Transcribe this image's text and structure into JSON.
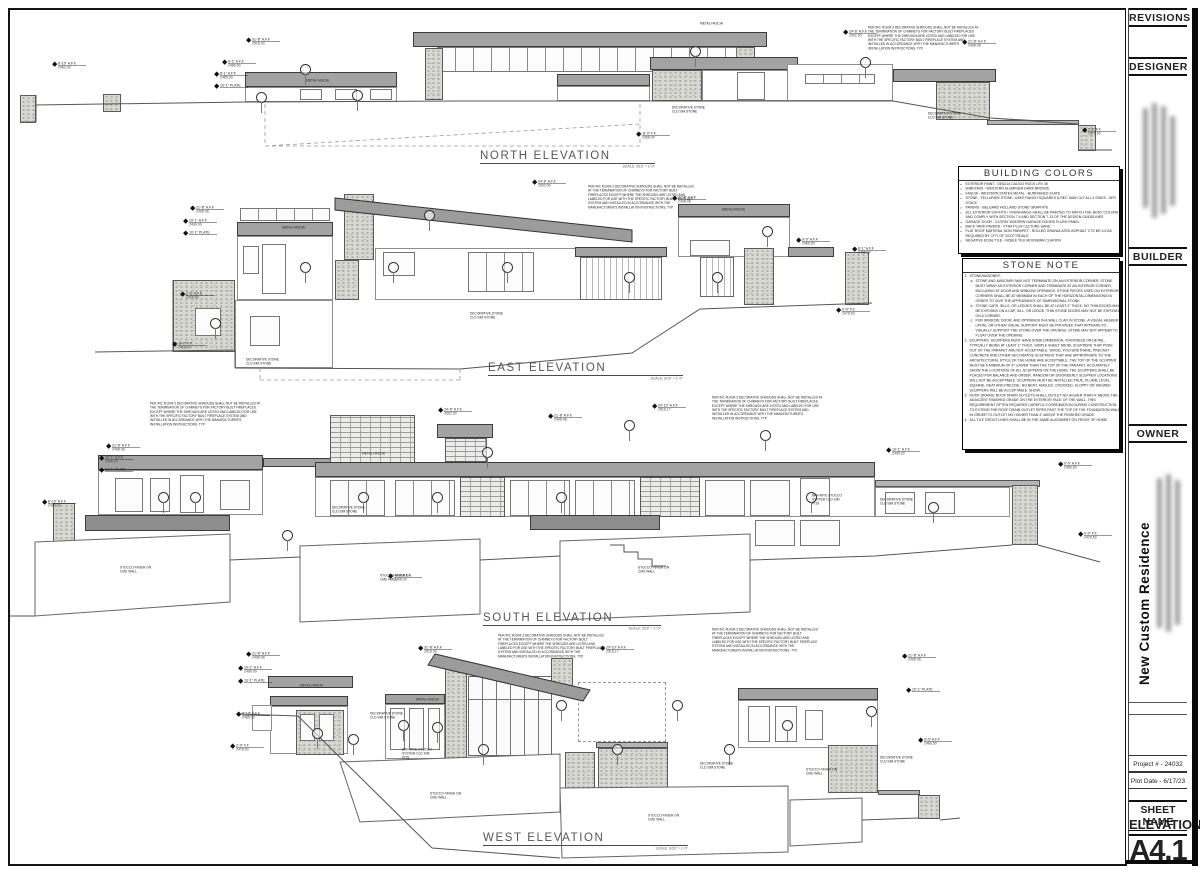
{
  "tb": {
    "revisions": "REVISIONS",
    "designer": "DESIGNER",
    "builder": "BUILDER",
    "owner": "OWNER",
    "project_name": "New Custom Residence",
    "project_number": "Project # - 24032",
    "plot_date": "Plot Date -  6/17/23",
    "sheet_name_label": "SHEET NAME",
    "sheet_name": "ELEVATIONS",
    "sheet_number": "A4.1"
  },
  "elevations": [
    {
      "id": "north",
      "title": "NORTH ELEVATION",
      "scale": "SCALE: 3/16\" = 1'-0\""
    },
    {
      "id": "east",
      "title": "EAST ELEVATION",
      "scale": "SCALE: 3/16\" = 1'-0\""
    },
    {
      "id": "south",
      "title": "SOUTH ELEVATION",
      "scale": "SCALE: 3/16\" = 1'-0\""
    },
    {
      "id": "west",
      "title": "WEST ELEVATION",
      "scale": "SCALE: 3/16\" = 1'-0\""
    }
  ],
  "notes": {
    "building_colors": {
      "title": "BUILDING COLORS",
      "items": [
        "EXTERIOR PAINT - DE6214 CALICO ROCK LRV 35",
        "WINDOWS - WESTERN ALUMINUM DARK BRONZE",
        "FASCIA - WESTERN STATES METAL - BURNISHED SLATE",
        "STONE - TELLURIDE STONE, OAKS RANCH SQUARES & REC SAW CUT ALL 4 SIDES - DRY STACK",
        "PAVERS - BELGARD HOLLAND STONE GRAPHITE",
        "ALL EXTERIOR SOFFITS / OVERHANGS SHALL BE PAINTED TO MATCH THE BODY COLORS AND COMPLY WITH SECTION 7.4 AND SECTION 7.13 OF THE DESIGN GUIDELINES",
        "GARAGE DOOR - CLOPAY MODERN GARAGE DOORS FLUSH PANEL",
        "BACK YARD PAVERS - XTRA PLUS CULTURE SAND",
        "FLAT ROOF MATERIAL NON PARAPET - ROLLED GRANULATED ASPHALT CTS BR 4.5 AS REQUIRED BY CITY OF SCOTTSDALE",
        "NEGATIVE EDGE TILE - NOBLE TILE MOSSMAN CLARION"
      ]
    },
    "stone_note": {
      "title": "STONE NOTE",
      "items": [
        {
          "b": "1.",
          "ind": 0,
          "t": "STONE/MASONRY:"
        },
        {
          "b": "a.",
          "ind": 1,
          "t": "STONE AND MASONRY MAY NOT TERMINATE ON AN EXTERIOR CORNER. STONE MUST WRAP AN EXTERIOR CORNER AND TERMINATE AT AN INTERIOR CORNER, INCLUDING AT DOOR AND WINDOW OPENINGS. STONE PIECES USED ON EXTERIOR CORNERS SHALL BE AT MINIMUM IN EACH OF THE HORIZONTAL DIMENSIONS IN ORDER TO GIVE THE APPEARANCE OF DIMENSIONAL STONE."
        },
        {
          "b": "b.",
          "ind": 1,
          "t": "STONE CAPS, SILLS, OR LEDGES SHALL BE AT LEAST 2\" THICK. NO THIN EDGES MAY BE EXPOSED ON A CAP, SILL, OR LEDGE. THIN STONE EDGES MAY NOT BE EXPOSED ON A CORNER."
        },
        {
          "b": "c.",
          "ind": 1,
          "t": "FOR WINDOW, DOOR, AND OPENINGS IN A WALL CLAD IN STONE, A VISUAL HEADER / LINTEL OR OTHER VISUAL SUPPORT MUST BE PROVIDED THAT APPEARS TO VISUALLY SUPPORT THE STONE OVER THE OPENING. STONE MAY NOT APPEAR TO FLOAT OVER THE OPENING."
        },
        {
          "b": "2.",
          "ind": 0,
          "t": "SCUPPERS: SCUPPERS MUST HAVE SOME DIMENSION, THICKNESS OR DETAIL, TYPICALLY BEING AT LEAST 1\" THICK. SIMPLE SHEET METAL SCUPPERS THAT POKE OUT OF THE PARAPET ARE NOT ACCEPTABLE. WOOD, POLYURETHANE, PRECAST CONCRETE AND OTHER DECORATIVE SCUPPERS THAT ARE APPROPRIATE TO THE ARCHITECTURAL STYLE OF THE HOME ARE ACCEPTABLE. THE TOP OF THE SCUPPER MUST BE A MINIMUM OF 6\" LOWER THAN THE TOP OF THE PARAPET. ACCURATELY SHOW THE LOCATIONS OF ALL SCUPPERS ON THE HOME. THE SCUPPERS SHALL BE PLACED FOR BALANCE AND ORDER. RANDOM OR DISORDERLY SCUPPER LOCATIONS WILL NOT BE ACCEPTABLE. SCUPPERS MUST BE INSTALLED TRUE, PLUMB, LEVEL, SQUARE, NEAT AND PRECISE. NO BENT, ANGLED, CROOKED, SLOPPY OR SKEWED SCUPPERS WILL BE ACCEPTABLE. SHOW."
        },
        {
          "b": "3.",
          "ind": 0,
          "t": "ROOF DRAINS: ROOF DRAIN OUTLETS SHALL OUTLET NO HIGHER THAN 4\" ABOVE THE ADJACENT FINISHED GRADE ON THE EXTERIOR FACE OF THE WALL. THIS REQUIREMENT OFTEN REQUIRES CAREFUL COORDINATION DURING CONSTRUCTION TO EXTEND THE ROOF DRAIN OUTLET PIPES PAST THE TOP OF THE FOUNDATION WALL IN ORDER TO OUTLET NO HIGHER THAN 4\" ABOVE THE FINISHED GRADE."
        },
        {
          "b": "4.",
          "ind": 0,
          "t": "ALL TILE GROUT LINES SHALL BE IN THE SAME ALIGNMENT ON FRONT OF HOME."
        }
      ]
    }
  },
  "chimney_note": "PER IRC R1004.3 DECORATIVE SHROUDS SHALL NOT BE INSTALLED AT THE TERMINATION OF CHIMNEYS FOR FACTORY BUILT FIREPLACES EXCEPT WHERE THE SHROUDS ARE LISTED AND LABELED FOR USE WITH THE SPECIFIC FACTORY BUILT FIREPLACE SYSTEM AND INSTALLED IN ACCORDANCE WITH THE MANUFACTURER'S INSTALLATION INSTRUCTIONS. TYP.",
  "annotations": {
    "north": {
      "callouts": [
        [
          246,
          38,
          "31'-8\" A.F.F.",
          "2518.00"
        ],
        [
          843,
          30,
          "24'-6\" A.F.F.",
          "2502.50"
        ],
        [
          962,
          40,
          "21'-8\" A.F.F.",
          "2498.08"
        ],
        [
          222,
          60,
          "9'-1\" A.F.F.",
          "2486.50"
        ],
        [
          214,
          72,
          "8'-1\" A.F.F.",
          "2485.00"
        ],
        [
          214,
          84,
          "10'-1\" PLATE",
          ""
        ],
        [
          52,
          62,
          "8'-10\" A.F.F.",
          "2482.00"
        ],
        [
          1082,
          128,
          "0'-0\" F.F.",
          "2476.50"
        ],
        [
          636,
          132,
          "-8'-0\" F.F.",
          "2468.00"
        ]
      ],
      "circles": [
        [
          256,
          92
        ],
        [
          352,
          90
        ],
        [
          690,
          46
        ],
        [
          860,
          57
        ],
        [
          300,
          64
        ]
      ],
      "labels": [
        [
          306,
          79,
          "METAL FASCIA"
        ],
        [
          700,
          22,
          "METAL FASCIA"
        ],
        [
          672,
          106,
          "DECORATIVE STONE\nCLD SIM STONE"
        ],
        [
          928,
          112,
          "DECORATIVE STONE\nCLD SIM STONE"
        ]
      ],
      "notes": [
        [
          868,
          26,
          112
        ]
      ]
    },
    "east": {
      "callouts": [
        [
          190,
          206,
          "21'-8\" A.F.F.",
          "2498.08"
        ],
        [
          183,
          219,
          "19'-1\" A.F.F.",
          "2496.00"
        ],
        [
          183,
          231,
          "10'-1\" PLATE",
          ""
        ],
        [
          532,
          180,
          "24'-6\" A.F.F.",
          "2502.50"
        ],
        [
          672,
          196,
          "21'-8\" A.F.F.",
          "2498.08"
        ],
        [
          796,
          238,
          "9'-0\" A.F.F.",
          "2486.50"
        ],
        [
          852,
          247,
          "8'-1\" A.F.F.",
          "2485.00"
        ],
        [
          180,
          292,
          "2'-0\" A.F.F.",
          "2478.50"
        ],
        [
          172,
          342,
          "-8'-0\" F.F.",
          "2468.00"
        ],
        [
          836,
          308,
          "0'-0\" F.F.",
          "2476.50"
        ]
      ],
      "circles": [
        [
          300,
          262
        ],
        [
          388,
          262
        ],
        [
          502,
          262
        ],
        [
          624,
          272
        ],
        [
          712,
          272
        ],
        [
          762,
          226
        ],
        [
          424,
          210
        ],
        [
          210,
          318
        ]
      ],
      "labels": [
        [
          282,
          226,
          "METAL FASCIA"
        ],
        [
          722,
          208,
          "METAL FASCIA"
        ],
        [
          470,
          312,
          "DECORATIVE STONE\nCLD SIM STONE"
        ],
        [
          246,
          358,
          "DECORATIVE STONE\nCLD SIM STONE"
        ]
      ],
      "notes": [
        [
          588,
          185,
          110
        ]
      ]
    },
    "south": {
      "callouts": [
        [
          106,
          444,
          "21'-8\" A.F.F.",
          "2498.08"
        ],
        [
          99,
          456,
          "19'-1\" A.F.F.",
          "2496.00"
        ],
        [
          99,
          468,
          "10'-1\" PLATE",
          ""
        ],
        [
          438,
          408,
          "24'-6\" A.F.F.",
          "2502.50"
        ],
        [
          548,
          414,
          "21'-8\" A.F.F.",
          "2498.08"
        ],
        [
          652,
          404,
          "29'-10\" A.F.F.",
          "2516.17"
        ],
        [
          886,
          448,
          "19'-1\" A.F.F.",
          "2496.00"
        ],
        [
          1058,
          462,
          "9'-0\" A.F.F.",
          "2486.50"
        ],
        [
          42,
          500,
          "8'-10\" A.F.F.",
          "2485.00"
        ],
        [
          388,
          574,
          "-8'-0\" F.F.",
          "2468.00"
        ],
        [
          1078,
          532,
          "0'-0\" F.F.",
          "2476.50"
        ]
      ],
      "circles": [
        [
          158,
          492
        ],
        [
          190,
          492
        ],
        [
          358,
          492
        ],
        [
          432,
          492
        ],
        [
          556,
          492
        ],
        [
          624,
          420
        ],
        [
          760,
          430
        ],
        [
          806,
          492
        ],
        [
          928,
          502
        ],
        [
          482,
          447
        ],
        [
          282,
          530
        ]
      ],
      "labels": [
        [
          362,
          452,
          "METAL FASCIA"
        ],
        [
          332,
          506,
          "DECORATIVE STONE\nCLD SIM STONE"
        ],
        [
          880,
          498,
          "DECORATIVE STONE\nCLD SIM STONE"
        ],
        [
          120,
          566,
          "STUCCO FINISH ON\nCMU WALL"
        ],
        [
          380,
          574,
          "STUCCO FINISH ON\nCMU WALL"
        ],
        [
          638,
          566,
          "STUCCO FINISH ON\nCMU WALL"
        ],
        [
          812,
          494,
          "BAR-RITE STUCCO\nSYSTEM CLD SIM\n#729"
        ]
      ],
      "notes": [
        [
          150,
          402,
          112
        ],
        [
          712,
          396,
          112
        ]
      ]
    },
    "west": {
      "callouts": [
        [
          246,
          652,
          "21'-8\" A.F.F.",
          "2498.08"
        ],
        [
          238,
          666,
          "19'-1\" A.F.F.",
          "2496.00"
        ],
        [
          238,
          679,
          "10'-1\" PLATE",
          ""
        ],
        [
          418,
          646,
          "31'-8\" A.F.F.",
          "2518.00"
        ],
        [
          600,
          646,
          "29'-10\" A.F.F.",
          "2516.17"
        ],
        [
          902,
          654,
          "21'-8\" A.F.F.",
          "2498.08"
        ],
        [
          906,
          688,
          "10'-1\" PLATE",
          ""
        ],
        [
          918,
          738,
          "9'-0\" A.F.F.",
          "2486.50"
        ],
        [
          236,
          712,
          "8'-10\" A.F.F.",
          "2485.00"
        ],
        [
          230,
          744,
          "2'-0\" F.F.",
          "2478.50"
        ]
      ],
      "circles": [
        [
          312,
          728
        ],
        [
          348,
          734
        ],
        [
          398,
          720
        ],
        [
          432,
          722
        ],
        [
          478,
          744
        ],
        [
          556,
          700
        ],
        [
          612,
          744
        ],
        [
          672,
          700
        ],
        [
          724,
          744
        ],
        [
          782,
          720
        ],
        [
          866,
          706
        ]
      ],
      "labels": [
        [
          300,
          684,
          "METAL FASCIA"
        ],
        [
          416,
          698,
          "METAL FASCIA"
        ],
        [
          370,
          712,
          "DECORATIVE STONE\nCLD SIM STONE"
        ],
        [
          402,
          748,
          "BAR-RITE STUCCO\nSYSTEM CLD SIM\n#729"
        ],
        [
          700,
          762,
          "DECORATIVE STONE\nCLD SIM STONE"
        ],
        [
          430,
          792,
          "STUCCO FINISH ON\nCMU WALL"
        ],
        [
          648,
          814,
          "STUCCO FINISH ON\nCMU WALL"
        ],
        [
          806,
          768,
          "STUCCO FINISH ON\nCMU WALL"
        ],
        [
          880,
          756,
          "DECORATIVE STONE\nCLD SIM STONE"
        ]
      ],
      "notes": [
        [
          498,
          634,
          110
        ],
        [
          712,
          628,
          110
        ]
      ]
    }
  }
}
